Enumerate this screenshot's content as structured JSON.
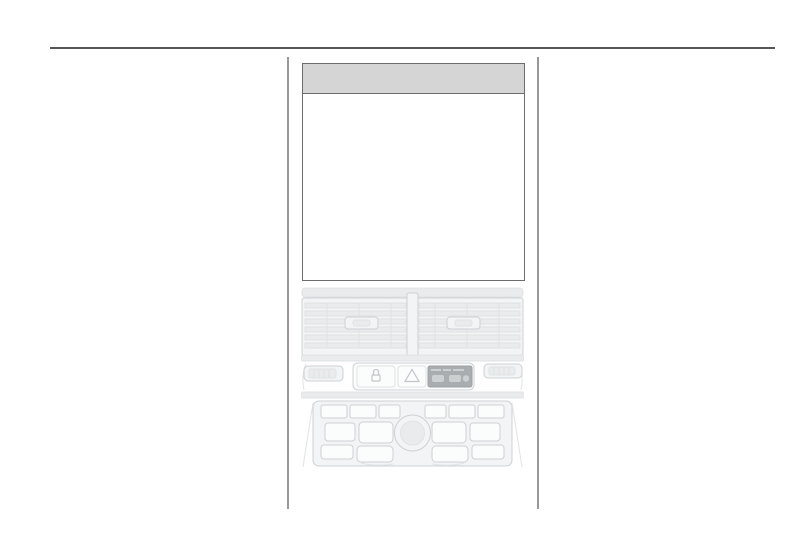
{
  "page": {
    "kind": "vehicle-owners-manual-page",
    "visible_text": ""
  },
  "colors": {
    "page-bg": "#ffffff",
    "top-rule": "#545658",
    "column-rule": "#98989a",
    "table-border": "#6d6d6f",
    "table-header-fill": "#d5d5d5",
    "art-line": "#ccd1d3",
    "art-line-soft": "#e0e3e4",
    "art-fill": "#f3f4f5",
    "art-fill-mid": "#e9ebec",
    "art-dark-panel": "#a9adaf",
    "art-glyph": "#c2c6c9"
  },
  "table": {
    "header_label": "",
    "body_text": ""
  },
  "illustration": {
    "name": "centre-console-line-drawing",
    "parts": [
      "air-vents",
      "vent-divider",
      "vent-adjuster-left",
      "vent-adjuster-right",
      "left-thumbwheel-control",
      "central-locking-button",
      "hazard-warning-button",
      "airbag-status-display",
      "right-thumbwheel-control",
      "infotainment-panel",
      "volume-knob",
      "preset-buttons"
    ]
  }
}
